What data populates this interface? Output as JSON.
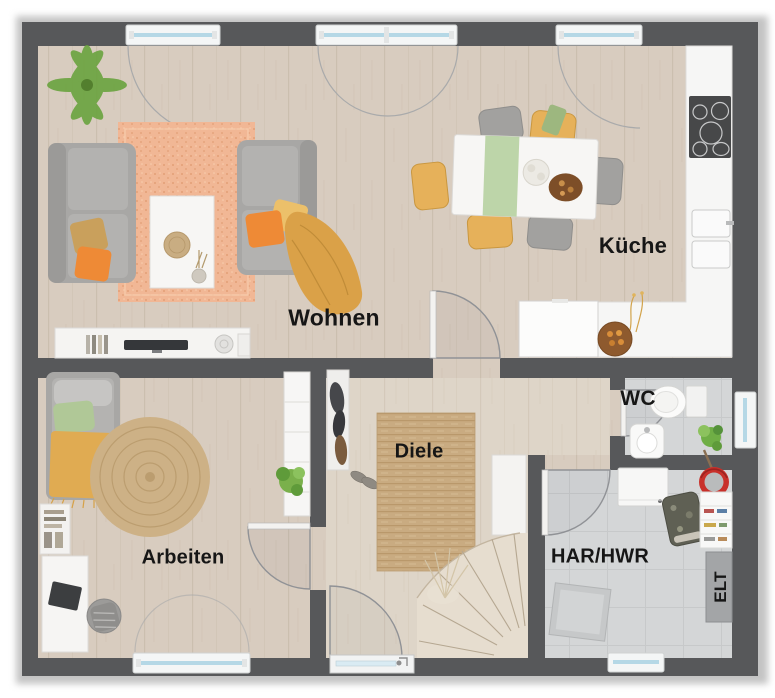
{
  "rooms": {
    "wohnen": {
      "label": "Wohnen"
    },
    "kueche": {
      "label": "Küche"
    },
    "arbeiten": {
      "label": "Arbeiten"
    },
    "diele": {
      "label": "Diele"
    },
    "wc": {
      "label": "WC"
    },
    "har_hwr": {
      "label": "HAR/HWR"
    },
    "elt": {
      "label": "ELT"
    }
  },
  "colors": {
    "wall": "#57585a",
    "floor_wood": "#d8ccbf",
    "floor_wood_light": "#ded5c8",
    "floor_tile": "#d4d6d7",
    "rug_peach": "#f1b795",
    "rug_jute": "#c9ab81",
    "sofa_gray": "#a8a7a5",
    "accent_orange": "#ee8a36",
    "accent_mustard": "#e0ab52",
    "accent_yellow_chair": "#e6b15a",
    "accent_green_plant": "#6aa33f",
    "pale_green": "#b9d3a4",
    "window_glass": "#b5d8e6",
    "counter_white": "#f6f6f5",
    "cooktop_dark": "#474849",
    "bucket_red": "#c8302a",
    "elt_panel": "#a3a5a7"
  }
}
